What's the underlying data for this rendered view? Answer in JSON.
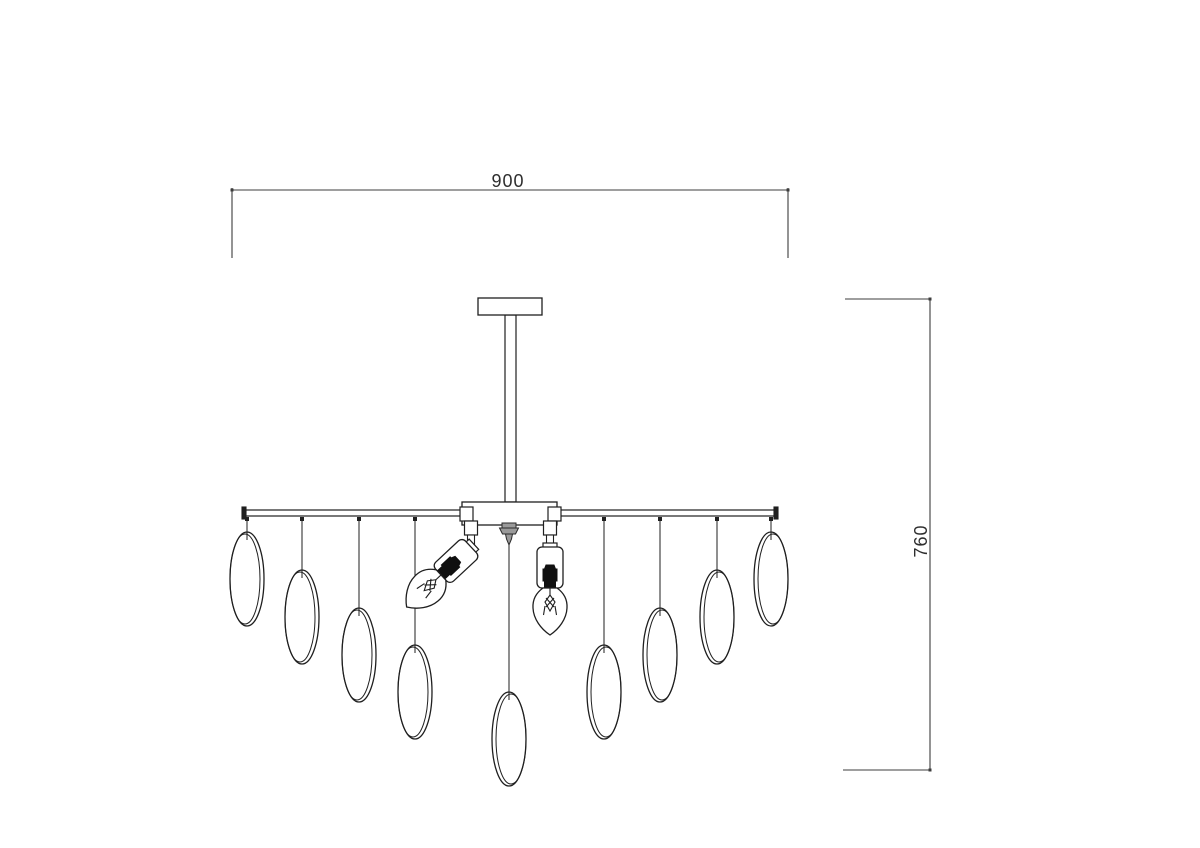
{
  "canvas": {
    "width": 1200,
    "height": 848,
    "background": "#ffffff"
  },
  "colors": {
    "fixture_line": "#1f1f1f",
    "dimension_line": "#3d3d3d",
    "white_fill": "#ffffff",
    "finial_fill": "#9a9a9a",
    "holder_fill": "#101010",
    "text": "#2e2e2e"
  },
  "dimensions": {
    "width": {
      "label": "900",
      "line": {
        "x1": 232,
        "y1": 190,
        "x2": 788,
        "y2": 190
      },
      "extensions": [
        {
          "x1": 232,
          "y1": 188,
          "x2": 232,
          "y2": 258
        },
        {
          "x1": 788,
          "y1": 188,
          "x2": 788,
          "y2": 258
        }
      ]
    },
    "height": {
      "label": "760",
      "line": {
        "x1": 930,
        "y1": 299,
        "x2": 930,
        "y2": 770
      },
      "extensions": [
        {
          "x1": 845,
          "y1": 299,
          "x2": 930,
          "y2": 299
        },
        {
          "x1": 843,
          "y1": 770,
          "x2": 931,
          "y2": 770
        }
      ]
    }
  },
  "fixture": {
    "canopy": {
      "x": 478,
      "y": 298,
      "w": 64,
      "h": 17
    },
    "stem": {
      "x": 505,
      "y": 315,
      "w": 11,
      "h": 187
    },
    "body": {
      "x": 462,
      "y": 502,
      "w": 95,
      "h": 23
    },
    "bar": {
      "x": 243,
      "y": 510,
      "w": 534,
      "h": 6
    },
    "bar_end_caps": [
      {
        "x": 242,
        "y": 507,
        "w": 4,
        "h": 12
      },
      {
        "x": 774,
        "y": 507,
        "w": 4,
        "h": 12
      }
    ],
    "bar_clamps": [
      {
        "x": 460,
        "y": 507,
        "w": 13,
        "h": 14
      },
      {
        "x": 548,
        "y": 507,
        "w": 13,
        "h": 14
      }
    ],
    "finial": {
      "x": 509,
      "y": 523
    },
    "center_cord": {
      "x": 509,
      "y1": 545,
      "y2": 700
    },
    "drop_rx": 17,
    "drop_ry": 47,
    "drops": [
      {
        "x": 247,
        "ellipse_top": 532,
        "double_edge": "right"
      },
      {
        "x": 302,
        "ellipse_top": 570,
        "double_edge": "right"
      },
      {
        "x": 359,
        "ellipse_top": 608,
        "double_edge": "right"
      },
      {
        "x": 415,
        "ellipse_top": 645,
        "double_edge": "right"
      },
      {
        "x": 509,
        "ellipse_top": 692,
        "double_edge": "left",
        "from_finial": true
      },
      {
        "x": 604,
        "ellipse_top": 645,
        "double_edge": "left"
      },
      {
        "x": 660,
        "ellipse_top": 608,
        "double_edge": "left"
      },
      {
        "x": 717,
        "ellipse_top": 570,
        "double_edge": "left"
      },
      {
        "x": 771,
        "ellipse_top": 532,
        "double_edge": "left"
      }
    ],
    "bulbs": [
      {
        "side": "left",
        "x": 471,
        "rotation": 47
      },
      {
        "side": "right",
        "x": 550,
        "rotation": 0
      }
    ]
  }
}
